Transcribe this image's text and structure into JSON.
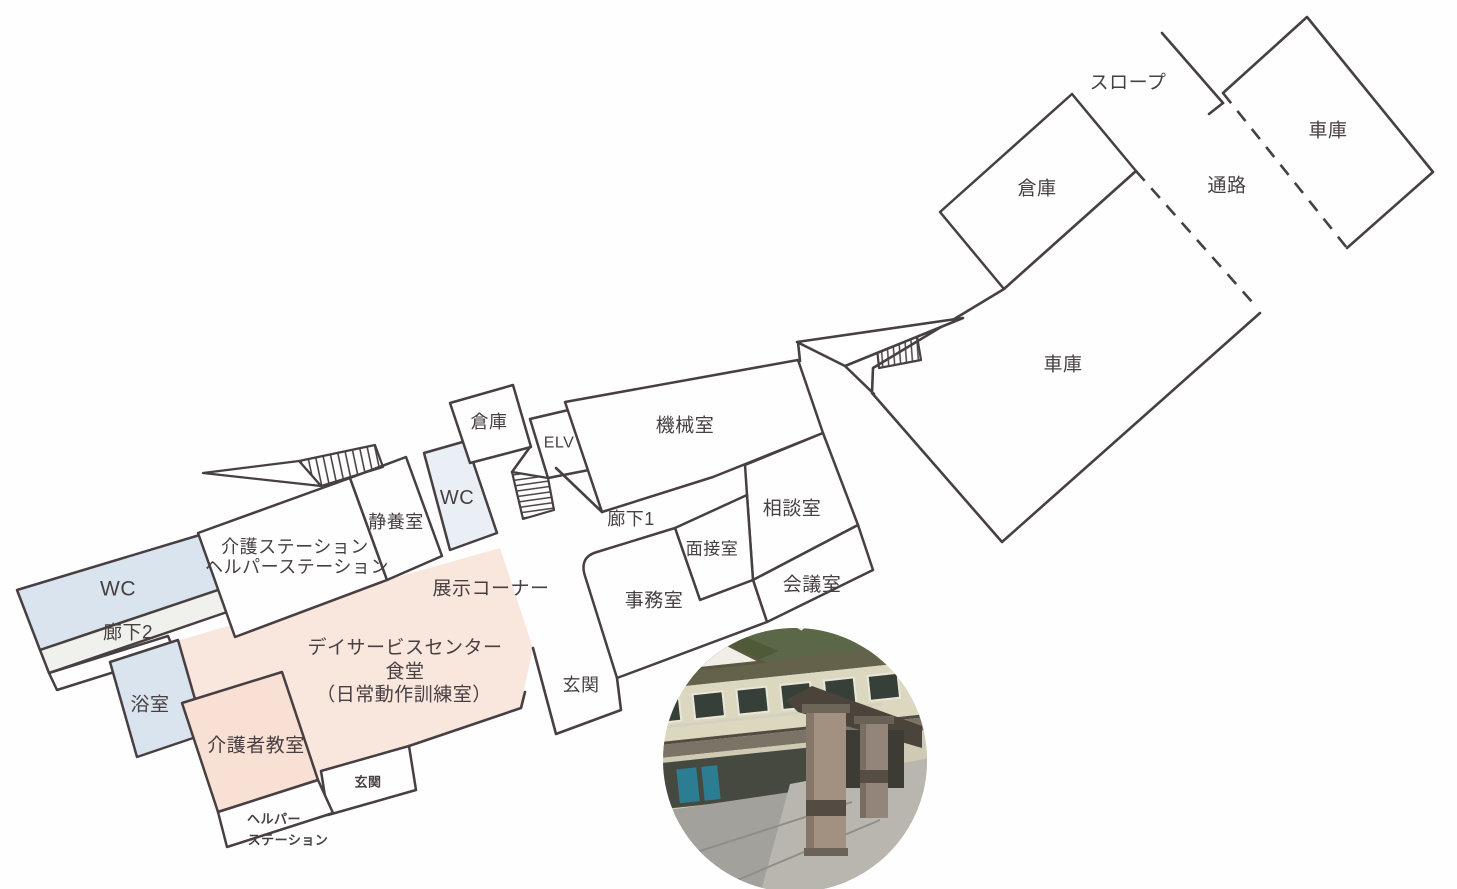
{
  "meta": {
    "type": "facility-floor-plan",
    "background": "#fefefe",
    "ink": "#473f42"
  },
  "palette": {
    "white": "#fefefe",
    "blue": "#d9e4ee",
    "blue_pale": "#e9eff5",
    "pink": "#f9e6dc",
    "pink_room": "#f8e0d5",
    "strip": "#f0f1ed",
    "none": "none"
  },
  "rooms": [
    {
      "id": "dayservice-hall",
      "fill": "pink",
      "stroke": false,
      "points": "163,645 387,580 500,548 533,648 520,708 409,746 321,771 318,780 282,672 182,703 178,640",
      "labels": [
        {
          "t": "デイサービスセンター",
          "x": 405,
          "y": 648,
          "s": 19
        },
        {
          "t": "食堂",
          "x": 405,
          "y": 672,
          "s": 19
        },
        {
          "t": "（日常動作訓練室）",
          "x": 404,
          "y": 695,
          "s": 19
        }
      ]
    },
    {
      "id": "wc-left",
      "fill": "blue",
      "stroke": true,
      "points": "17,590 203,534 224,588 40,650",
      "labels": [
        {
          "t": "WC",
          "x": 118,
          "y": 589,
          "s": 21
        }
      ]
    },
    {
      "id": "corridor-2",
      "fill": "strip",
      "stroke": true,
      "points": "40,650 224,588 233,610 49,673",
      "labels": [
        {
          "t": "廊下2",
          "x": 128,
          "y": 633,
          "s": 19
        }
      ]
    },
    {
      "id": "ledge",
      "fill": "none",
      "stroke": true,
      "points": "49,673 168,636 175,653 57,690",
      "labels": []
    },
    {
      "id": "bathroom",
      "fill": "blue",
      "stroke": true,
      "points": "110,662 178,640 205,734 137,757",
      "labels": [
        {
          "t": "浴室",
          "x": 150,
          "y": 705,
          "s": 19
        }
      ]
    },
    {
      "id": "care-station",
      "fill": "white",
      "stroke": true,
      "points": "198,533 350,478 387,580 235,637",
      "labels": [
        {
          "t": "介護ステーション",
          "x": 295,
          "y": 547,
          "s": 18
        },
        {
          "t": "ヘルパーステーション",
          "x": 297,
          "y": 567,
          "s": 18
        }
      ]
    },
    {
      "id": "rest-room",
      "fill": "white",
      "stroke": true,
      "points": "350,478 406,457 442,556 387,580",
      "labels": [
        {
          "t": "静養室",
          "x": 396,
          "y": 522,
          "s": 18
        }
      ]
    },
    {
      "id": "wc-mid",
      "fill": "blue_pale",
      "stroke": true,
      "points": "424,453 466,441 497,533 450,550",
      "labels": [
        {
          "t": "WC",
          "x": 457,
          "y": 498,
          "s": 20
        }
      ]
    },
    {
      "id": "storage-mid",
      "fill": "white",
      "stroke": true,
      "points": "450,403 513,385 531,447 470,463",
      "labels": [
        {
          "t": "倉庫",
          "x": 489,
          "y": 422,
          "s": 18
        }
      ]
    },
    {
      "id": "elevator",
      "fill": "white",
      "stroke": true,
      "points": "530,419 577,408 589,470 548,478",
      "labels": [
        {
          "t": "ELV",
          "x": 559,
          "y": 443,
          "s": 16
        }
      ]
    },
    {
      "id": "machine-room",
      "fill": "white",
      "stroke": true,
      "points": "565,402 798,360 823,433 713,477 602,512",
      "labels": [
        {
          "t": "機械室",
          "x": 685,
          "y": 426,
          "s": 19
        }
      ]
    },
    {
      "id": "consult-room",
      "fill": "white",
      "stroke": true,
      "points": "745,465 823,433 858,525 753,580 747,495",
      "labels": [
        {
          "t": "相談室",
          "x": 792,
          "y": 509,
          "s": 19
        }
      ]
    },
    {
      "id": "interview-room",
      "fill": "white",
      "stroke": true,
      "points": "675,528 747,495 753,580 700,600",
      "labels": [
        {
          "t": "面接室",
          "x": 712,
          "y": 549,
          "s": 17
        }
      ]
    },
    {
      "id": "meeting-room",
      "fill": "white",
      "stroke": true,
      "points": "753,580 858,525 873,570 767,622",
      "labels": [
        {
          "t": "会議室",
          "x": 812,
          "y": 585,
          "s": 19
        }
      ]
    },
    {
      "id": "office",
      "fill": "white",
      "stroke": true,
      "path": "M 597,552 L 675,528 L 700,600 L 753,580 L 767,622 L 617,678 L 585,576 Q 579,557 597,552 Z",
      "labels": [
        {
          "t": "事務室",
          "x": 654,
          "y": 601,
          "s": 19
        }
      ]
    },
    {
      "id": "caregiver-classroom",
      "fill": "pink_room",
      "stroke": true,
      "points": "182,703 282,672 318,780 218,812",
      "labels": [
        {
          "t": "介護者教室",
          "x": 256,
          "y": 746,
          "s": 19
        }
      ]
    },
    {
      "id": "entrance-bottom",
      "fill": "white",
      "stroke": true,
      "points": "321,771 409,746 416,790 328,815",
      "labels": [
        {
          "t": "玄関",
          "x": 368,
          "y": 782,
          "s": 13,
          "b": true
        }
      ]
    },
    {
      "id": "helper-station",
      "fill": "white",
      "stroke": true,
      "points": "218,812 318,780 333,813 227,847",
      "labels": [
        {
          "t": "ヘルパー",
          "x": 274,
          "y": 819,
          "s": 13,
          "b": true
        },
        {
          "t": "ステーション",
          "x": 288,
          "y": 840,
          "s": 13,
          "b": true
        }
      ]
    },
    {
      "id": "storage-top",
      "fill": "white",
      "stroke": true,
      "points": "940,212 1072,94 1136,171 1004,289",
      "labels": [
        {
          "t": "倉庫",
          "x": 1037,
          "y": 189,
          "s": 19
        }
      ]
    },
    {
      "id": "garage-main",
      "fill": "white",
      "stroke": false,
      "points": "1260,313 1002,542 872,393 873,368 1004,289 1136,171",
      "labels": [
        {
          "t": "車庫",
          "x": 1063,
          "y": 365,
          "s": 19
        }
      ]
    },
    {
      "id": "garage-top",
      "fill": "white",
      "stroke": false,
      "points": "1223,93 1307,17 1433,172 1347,248",
      "labels": [
        {
          "t": "車庫",
          "x": 1328,
          "y": 131,
          "s": 19
        }
      ]
    }
  ],
  "free_labels": [
    {
      "id": "corridor-1",
      "t": "廊下1",
      "x": 631,
      "y": 519,
      "s": 18
    },
    {
      "id": "exhibit-corner",
      "t": "展示コーナー",
      "x": 491,
      "y": 589,
      "s": 19
    },
    {
      "id": "entrance-main",
      "t": "玄関",
      "x": 581,
      "y": 685,
      "s": 18
    },
    {
      "id": "passage",
      "t": "通路",
      "x": 1227,
      "y": 186,
      "s": 19
    },
    {
      "id": "slope",
      "t": "スロープ",
      "x": 1128,
      "y": 83,
      "s": 19
    }
  ],
  "walls": [
    {
      "id": "garage-main-outline",
      "d": "M1260,313 L1002,542 L872,393 L873,368 L1004,289 L1136,171"
    },
    {
      "id": "garage-top-outline",
      "d": "M1347,248 L1433,172 L1307,17 L1223,93"
    },
    {
      "id": "slope-line",
      "d": "M1162,33 L1223,103"
    },
    {
      "id": "slope-tick",
      "d": "M1223,103 L1209,114"
    },
    {
      "id": "connector-triangle",
      "d": "M797,342 L963,318 L845,366 Z"
    },
    {
      "id": "connector-link",
      "d": "M845,366 L874,394"
    },
    {
      "id": "connector-stub",
      "d": "M798,342 L800,361"
    },
    {
      "id": "elv-diagonal",
      "d": "M512,472 L530,447"
    },
    {
      "id": "corridor1-funnel",
      "d": "M556,468 L602,512"
    },
    {
      "id": "hall-southeast-wall",
      "d": "M409,746 L521,708 L525,692"
    },
    {
      "id": "entrance-main-walls",
      "d": "M533,648 L556,734 L621,710 L617,678"
    }
  ],
  "dashed": [
    {
      "id": "passage-dash-left",
      "d": "M1136,171 L1253,303"
    },
    {
      "id": "passage-dash-right",
      "d": "M1223,93 L1347,248"
    }
  ],
  "stairs": [
    {
      "id": "stairs-upper-hatch",
      "points": "299,461 375,445 383,467 321,486",
      "pattern": "hatchA"
    },
    {
      "id": "stairs-upper-blade",
      "points": "203,473 299,461 321,486",
      "pattern": "none"
    },
    {
      "id": "stairs-mid-hatch",
      "points": "512,472 548,478 554,510 523,519",
      "pattern": "hatchB"
    },
    {
      "id": "ramp-garage-hatch",
      "points": "876,338 916,330 921,360 879,368",
      "pattern": "hatchC"
    }
  ]
}
